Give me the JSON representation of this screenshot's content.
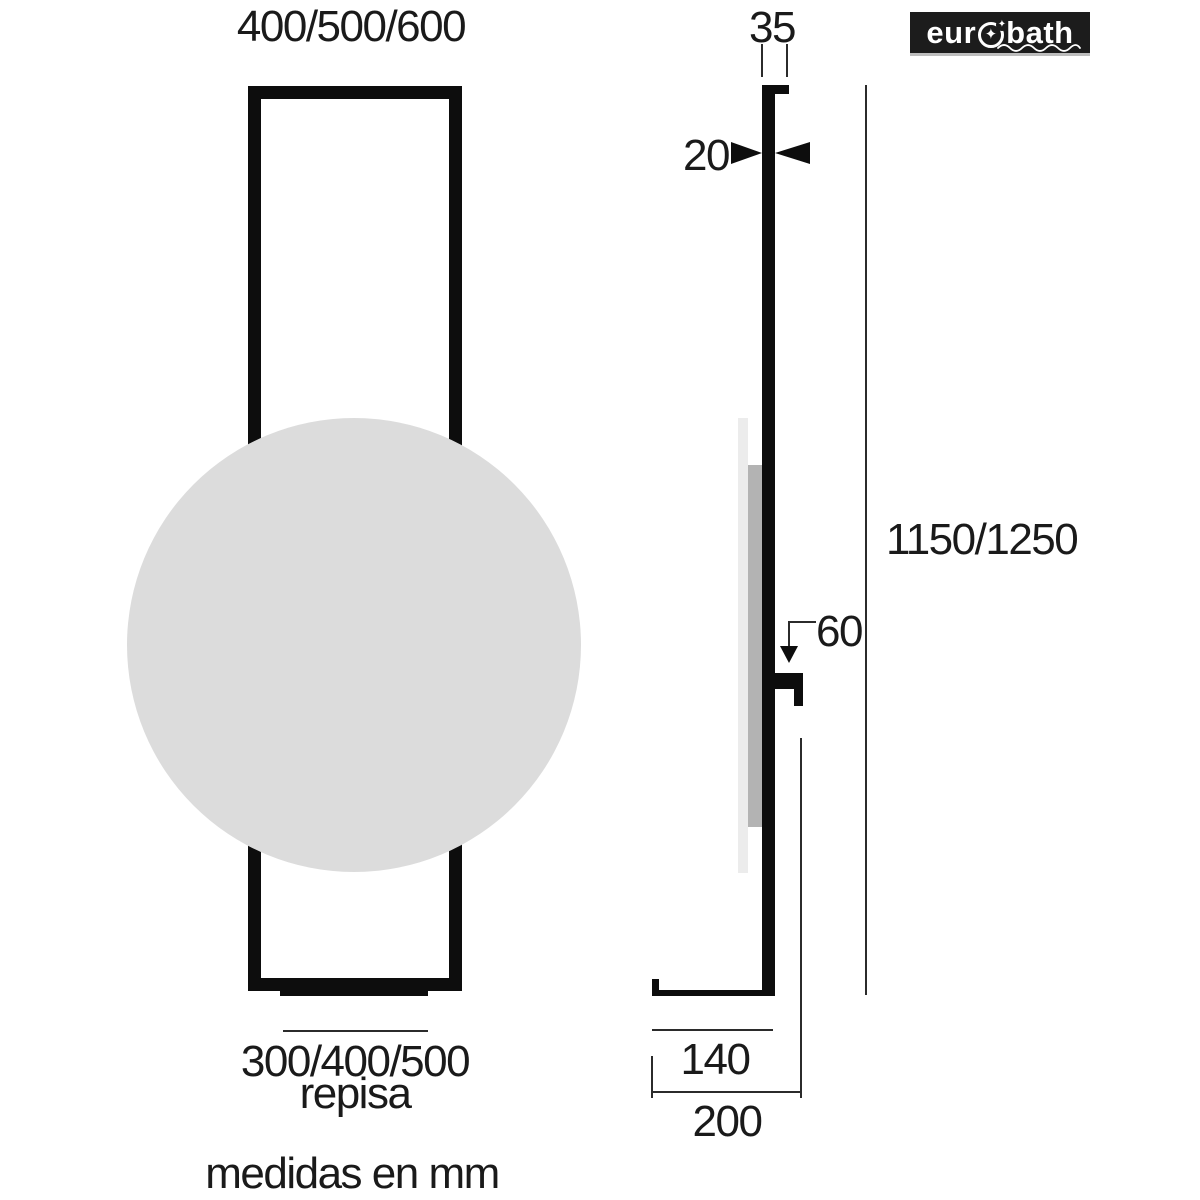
{
  "note": "medidas en mm",
  "logo": {
    "text_left": "eur",
    "text_right": "bath",
    "star": "✦",
    "accent_star": "✦"
  },
  "front_view": {
    "width_options": "400/500/600",
    "shelf_width_options": "300/400/500",
    "shelf_caption": "repisa"
  },
  "side_view": {
    "top_cap_depth": "35",
    "panel_thickness": "20",
    "height_options": "1150/1250",
    "shelf_offset": "60",
    "shelf_depth": "140",
    "total_depth": "200"
  },
  "colors": {
    "ink": "#1a1a1a",
    "ink-black": "#0d0d0d",
    "line": "#2b2b2b",
    "mirror-fill": "#dcdcdc",
    "glass-light": "#ececec",
    "glass-mid": "#b3b3b3",
    "logo-bg": "#1c1c1c",
    "logo-underline": "#bdbdbd",
    "logo-text": "#ffffff"
  }
}
